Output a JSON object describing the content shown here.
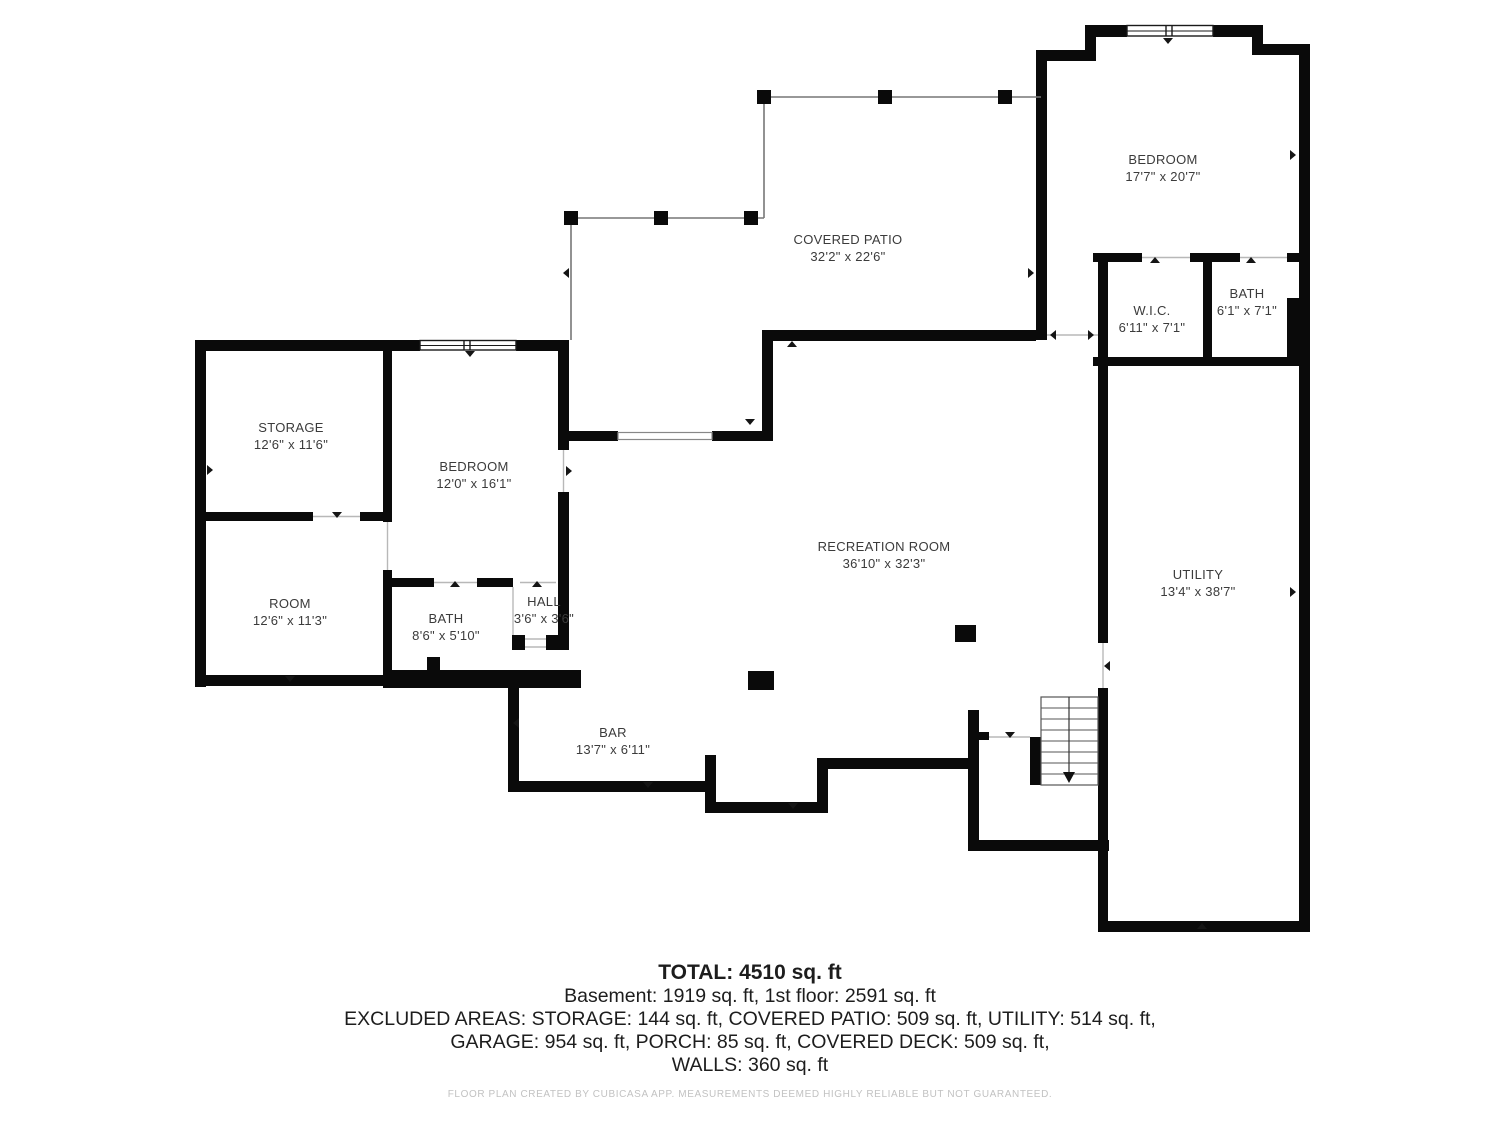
{
  "colors": {
    "wall": "#0a0a0a",
    "background": "#ffffff",
    "label_text": "#3b3b3b",
    "patio_line": "#777777",
    "opening_line": "#b8b8b8",
    "summary_text": "#1d1d1d",
    "footer_text": "#c2c2c2"
  },
  "rooms": [
    {
      "id": "storage",
      "name": "STORAGE",
      "dims": "12'6\" x 11'6\""
    },
    {
      "id": "bedroom-basement",
      "name": "BEDROOM",
      "dims": "12'0\" x 16'1\""
    },
    {
      "id": "room",
      "name": "ROOM",
      "dims": "12'6\" x 11'3\""
    },
    {
      "id": "bath-basement",
      "name": "BATH",
      "dims": "8'6\" x 5'10\""
    },
    {
      "id": "hall",
      "name": "HALL",
      "dims": "3'6\" x 3'6\""
    },
    {
      "id": "recreation-room",
      "name": "RECREATION ROOM",
      "dims": "36'10\" x 32'3\""
    },
    {
      "id": "bar",
      "name": "BAR",
      "dims": "13'7\" x 6'11\""
    },
    {
      "id": "utility",
      "name": "UTILITY",
      "dims": "13'4\" x 38'7\""
    },
    {
      "id": "covered-patio",
      "name": "COVERED PATIO",
      "dims": "32'2\" x 22'6\""
    },
    {
      "id": "bedroom-main",
      "name": "BEDROOM",
      "dims": "17'7\" x 20'7\""
    },
    {
      "id": "wic",
      "name": "W.I.C.",
      "dims": "6'11\" x 7'1\""
    },
    {
      "id": "bath-main",
      "name": "BATH",
      "dims": "6'1\" x 7'1\""
    }
  ],
  "summary": {
    "total": "TOTAL: 4510 sq. ft",
    "line1": "Basement: 1919 sq. ft, 1st floor: 2591 sq. ft",
    "line2": "EXCLUDED AREAS: STORAGE: 144 sq. ft, COVERED PATIO: 509 sq. ft, UTILITY: 514 sq. ft,",
    "line3": "GARAGE: 954 sq. ft, PORCH: 85 sq. ft, COVERED DECK: 509 sq. ft,",
    "line4": "WALLS: 360 sq. ft"
  },
  "footer": "FLOOR PLAN CREATED BY CUBICASA APP. MEASUREMENTS DEEMED HIGHLY RELIABLE BUT NOT GUARANTEED."
}
